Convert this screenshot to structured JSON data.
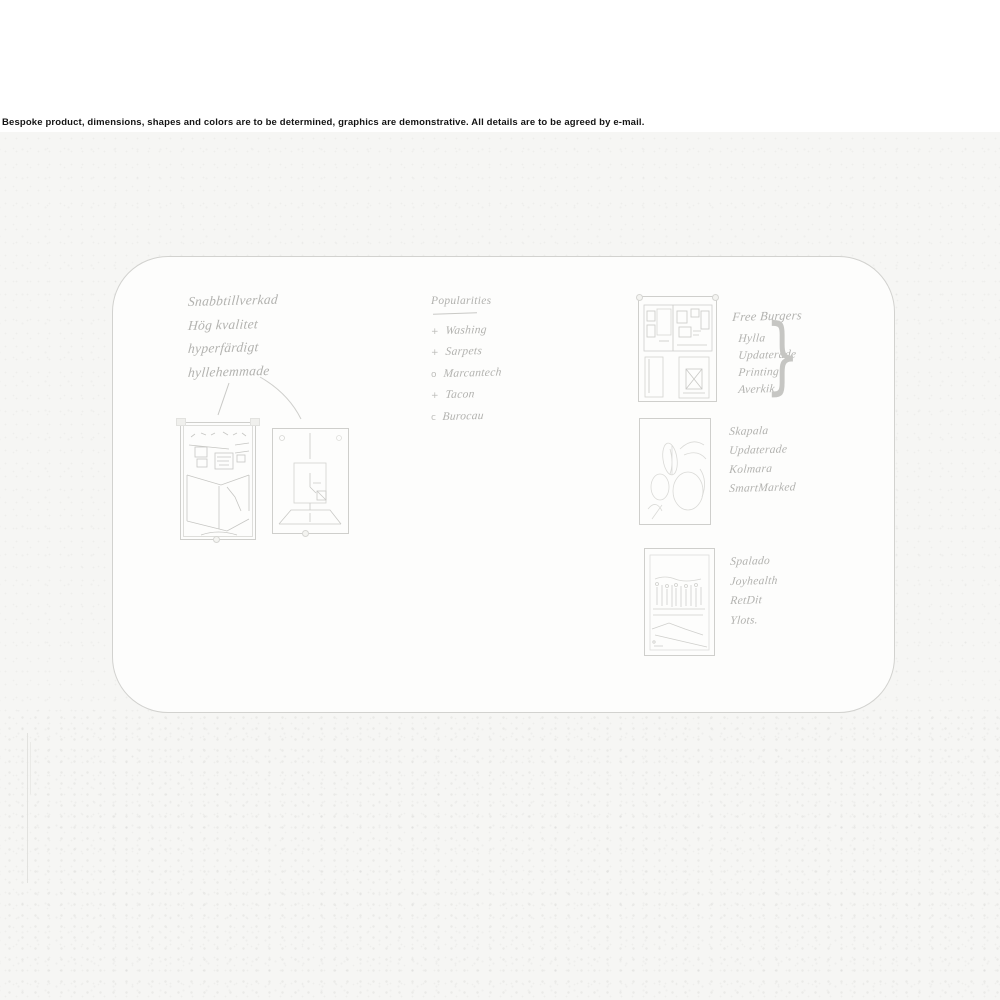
{
  "disclaimer": "Bespoke product, dimensions, shapes and colors are to be determined, graphics are demonstrative. All details are to be agreed by e-mail.",
  "colors": {
    "ink": "#b2b2af",
    "sketch_stroke": "#c9c9c6",
    "board_border": "#d2d2cf",
    "paper": "#f6f6f4"
  },
  "board": {
    "notes_top_left": {
      "lines": [
        "Snabbtillverkad",
        "Hög kvalitet",
        "hyperfärdigt",
        "hyllehemmade"
      ]
    },
    "center_list": {
      "title": "Popularities",
      "items": [
        {
          "marker": "+",
          "label": "Washing"
        },
        {
          "marker": "+",
          "label": "Sarpets"
        },
        {
          "marker": "o",
          "label": "Marcantech"
        },
        {
          "marker": "+",
          "label": "Tacon"
        },
        {
          "marker": "c",
          "label": "Burocau"
        }
      ]
    },
    "block_shelf": {
      "title": "Free Burgers",
      "lines": [
        "Hylla",
        "Updaterade",
        "Printing",
        "Averkik"
      ],
      "brace": "}"
    },
    "block_shapes": {
      "lines": [
        "Skapala",
        "Updaterade",
        "Kolmara",
        "SmartMarked"
      ]
    },
    "block_people": {
      "lines": [
        "Spalado",
        "Joyhealth",
        "RetDit",
        "Ylots."
      ]
    },
    "sketches": {
      "kitchen": "kitchen-interior-sketch",
      "diagram": "product-outline-sketch",
      "collage": "interior-collage-sketch",
      "flower": "abstract-floral-sketch",
      "crowd": "group-of-people-sketch"
    }
  }
}
